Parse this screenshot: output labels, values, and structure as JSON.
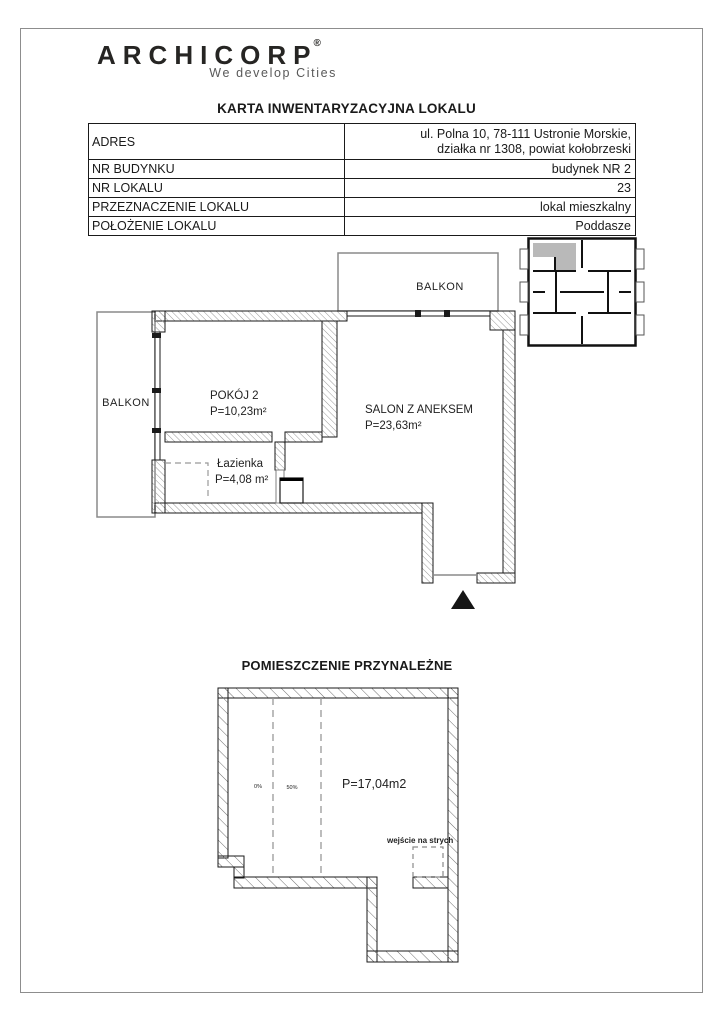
{
  "brand": {
    "name": "ARCHICORP",
    "registered": "®",
    "tagline": "We develop Cities"
  },
  "document": {
    "title": "KARTA INWENTARYZACYJNA LOKALU"
  },
  "info_table": {
    "rows": [
      {
        "label": "ADRES",
        "value_line1": "ul. Polna 10, 78-111 Ustronie Morskie,",
        "value_line2": "działka nr 1308, powiat kołobrzeski"
      },
      {
        "label": "NR BUDYNKU",
        "value": "budynek NR 2"
      },
      {
        "label": "NR LOKALU",
        "value": "23"
      },
      {
        "label": "PRZEZNACZENIE LOKALU",
        "value": "lokal mieszkalny"
      },
      {
        "label": "POŁOŻENIE LOKALU",
        "value": "Poddasze"
      }
    ]
  },
  "apartment_plan": {
    "balcony_top_label": "BALKON",
    "balcony_left_label": "BALKON",
    "room2_name": "POKÓJ 2",
    "room2_area": "P=10,23m²",
    "salon_name": "SALON Z ANEKSEM",
    "salon_area": "P=23,63m²",
    "bathroom_name": "Łazienka",
    "bathroom_area": "P=4,08 m²"
  },
  "annex_plan": {
    "title": "POMIESZCZENIE PRZYNALEŻNE",
    "area": "P=17,04m2",
    "attic_entrance_label": "wejście na strych",
    "height_zone_left": "0%",
    "height_zone_right": "50%"
  },
  "colors": {
    "ink": "#1a1a1a",
    "hatch": "#979797",
    "highlight_unit": "#b9b9b9",
    "page_border": "#8d8d8d"
  }
}
